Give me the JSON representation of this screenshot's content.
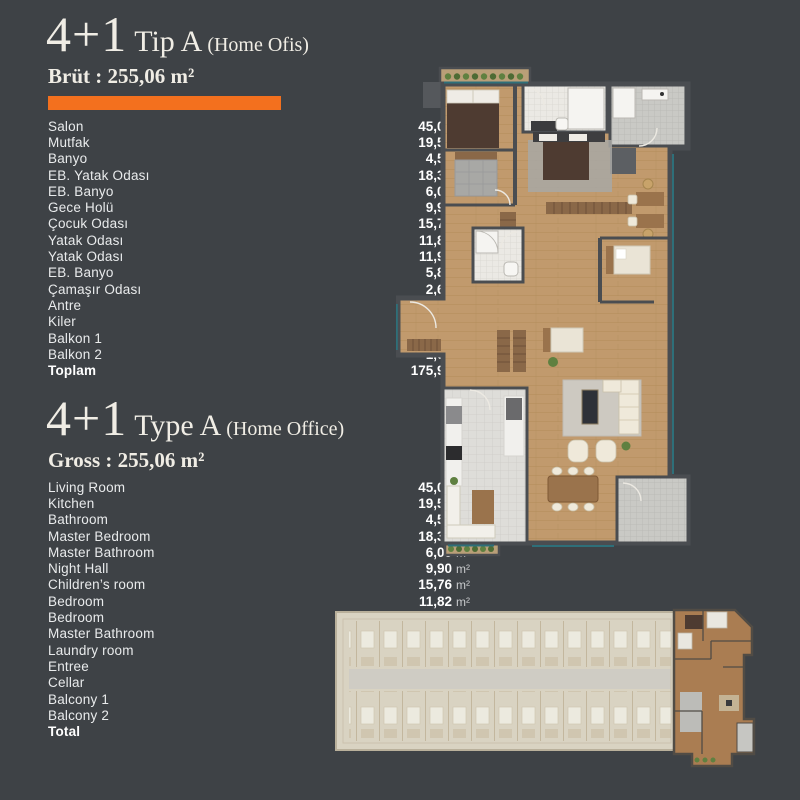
{
  "unit": "m²",
  "palette": {
    "background": "#3e4246",
    "accent": "#f3701e",
    "heading_text": "#f0ede5",
    "list_text": "#e9ebec",
    "value_text": "#ffffff",
    "unit_text": "#c9cbcd",
    "wall": "#4a4d51",
    "wood": "#c19a6d",
    "wood_dark": "#a9834f",
    "tile_white": "#ebe9e4",
    "tile_line": "#d8d6d0",
    "tile_gray": "#c9c9c5",
    "tile_gray_line": "#b7b7b3",
    "kitchen_tile": "#deddd9",
    "kitchen_tile_line": "#cdccc8",
    "furniture_dark": "#4e3b31",
    "furniture_wood": "#9a734c",
    "wardrobe": "#8a6848",
    "fabric_light": "#efe9da",
    "rug_gray": "#a8a8a5",
    "carpet": "#cdc9c1",
    "plant_green": "#5f8040",
    "window_teal": "#2e6f79",
    "keyplan_base": "#d9d3c2",
    "keyplan_line": "#c3b79e",
    "keyplan_corridor": "#cfccc4",
    "keyplan_unit_wood": "#aa7d52",
    "keyplan_wall": "#514c45"
  },
  "sections": {
    "tr": {
      "big": "4+1",
      "mid": "Tip A",
      "small": "(Home Ofis)",
      "subtitle": "Brüt : 255,06 m²",
      "rows": [
        {
          "label": "Salon",
          "value": "45,06"
        },
        {
          "label": "Mutfak",
          "value": "19,59"
        },
        {
          "label": "Banyo",
          "value": "4,52"
        },
        {
          "label": "EB. Yatak Odası",
          "value": "18,34"
        },
        {
          "label": "EB. Banyo",
          "value": "6,00"
        },
        {
          "label": "Gece Holü",
          "value": "9,90"
        },
        {
          "label": "Çocuk Odası",
          "value": "15,76"
        },
        {
          "label": "Yatak Odası",
          "value": "11,82"
        },
        {
          "label": "Yatak Odası",
          "value": "11,99"
        },
        {
          "label": "EB. Banyo",
          "value": "5,87"
        },
        {
          "label": "Çamaşır Odası",
          "value": "2,69"
        },
        {
          "label": "Antre",
          "value": "14,65"
        },
        {
          "label": "Kiler",
          "value": "6,51"
        },
        {
          "label": "Balkon 1",
          "value": "1,60"
        },
        {
          "label": "Balkon 2",
          "value": "1,60"
        },
        {
          "label": "Toplam",
          "value": "175,90",
          "bold": true
        }
      ]
    },
    "en": {
      "big": "4+1",
      "mid": "Type A",
      "small": "(Home Office)",
      "subtitle": "Gross : 255,06 m²",
      "rows": [
        {
          "label": "Living Room",
          "value": "45,06"
        },
        {
          "label": "Kitchen",
          "value": "19,59"
        },
        {
          "label": "Bathroom",
          "value": "4,52"
        },
        {
          "label": "Master Bedroom",
          "value": "18,34"
        },
        {
          "label": "Master Bathroom",
          "value": "6,00"
        },
        {
          "label": "Night Hall",
          "value": "9,90"
        },
        {
          "label": "Children’s room",
          "value": "15,76"
        },
        {
          "label": "Bedroom",
          "value": "11,82"
        },
        {
          "label": "Bedroom",
          "value": "11,99"
        },
        {
          "label": "Master Bathroom",
          "value": "5,87"
        },
        {
          "label": "Laundry room",
          "value": "2,69"
        },
        {
          "label": "Entree",
          "value": "14,65"
        },
        {
          "label": "Cellar",
          "value": "6,51"
        },
        {
          "label": "Balcony 1",
          "value": "1,60"
        },
        {
          "label": "Balcony 2",
          "value": "1,60"
        },
        {
          "label": "Total",
          "value": "175,90",
          "bold": true
        }
      ]
    }
  }
}
